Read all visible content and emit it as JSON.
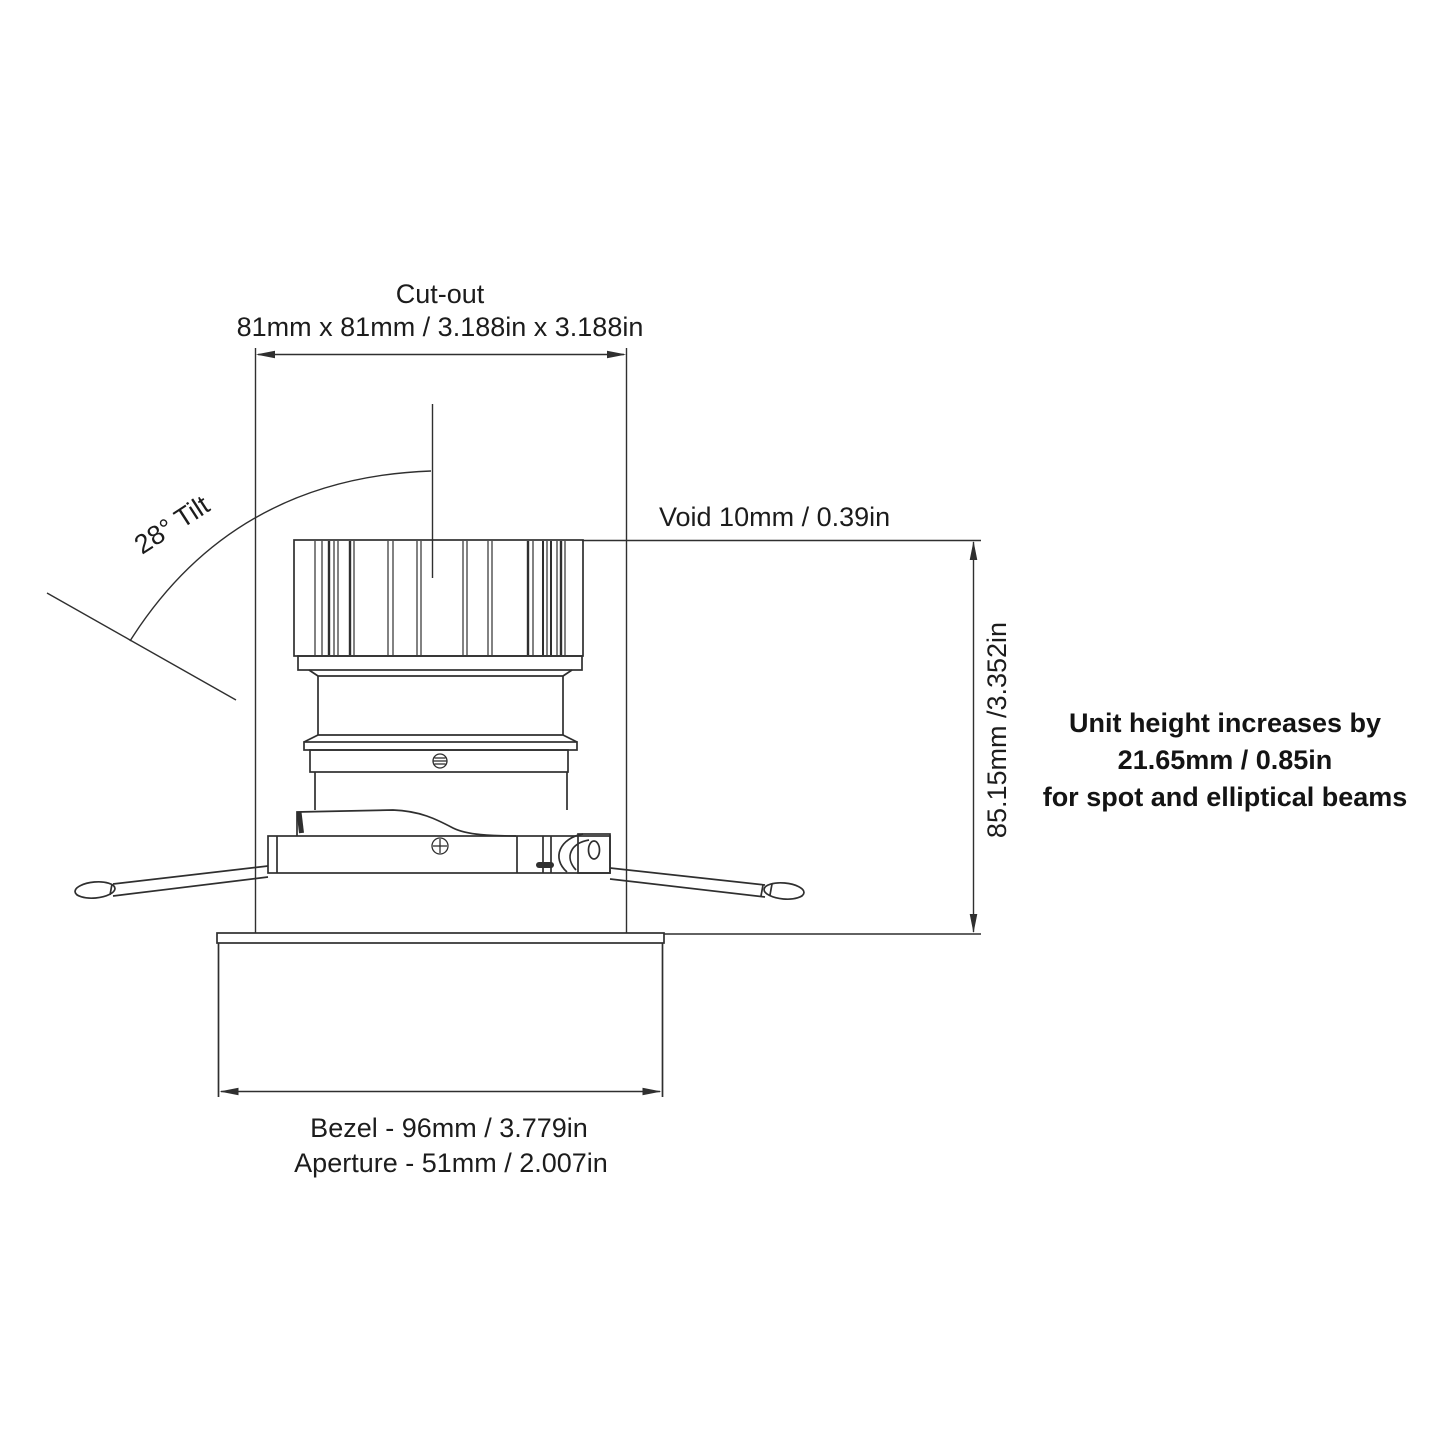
{
  "labels": {
    "cutout_title": "Cut-out",
    "cutout_value": "81mm x 81mm / 3.188in x 3.188in",
    "tilt": "28° Tilt",
    "void": "Void 10mm / 0.39in",
    "height": "85.15mm /3.352in",
    "bezel": "Bezel - 96mm / 3.779in",
    "aperture": "Aperture - 51mm / 2.007in"
  },
  "note": {
    "line1": "Unit height increases by",
    "line2": "21.65mm / 0.85in",
    "line3": "for spot and elliptical beams"
  },
  "colors": {
    "line": "#2f2f2f",
    "text": "#1c1c1c",
    "background": "#ffffff"
  }
}
